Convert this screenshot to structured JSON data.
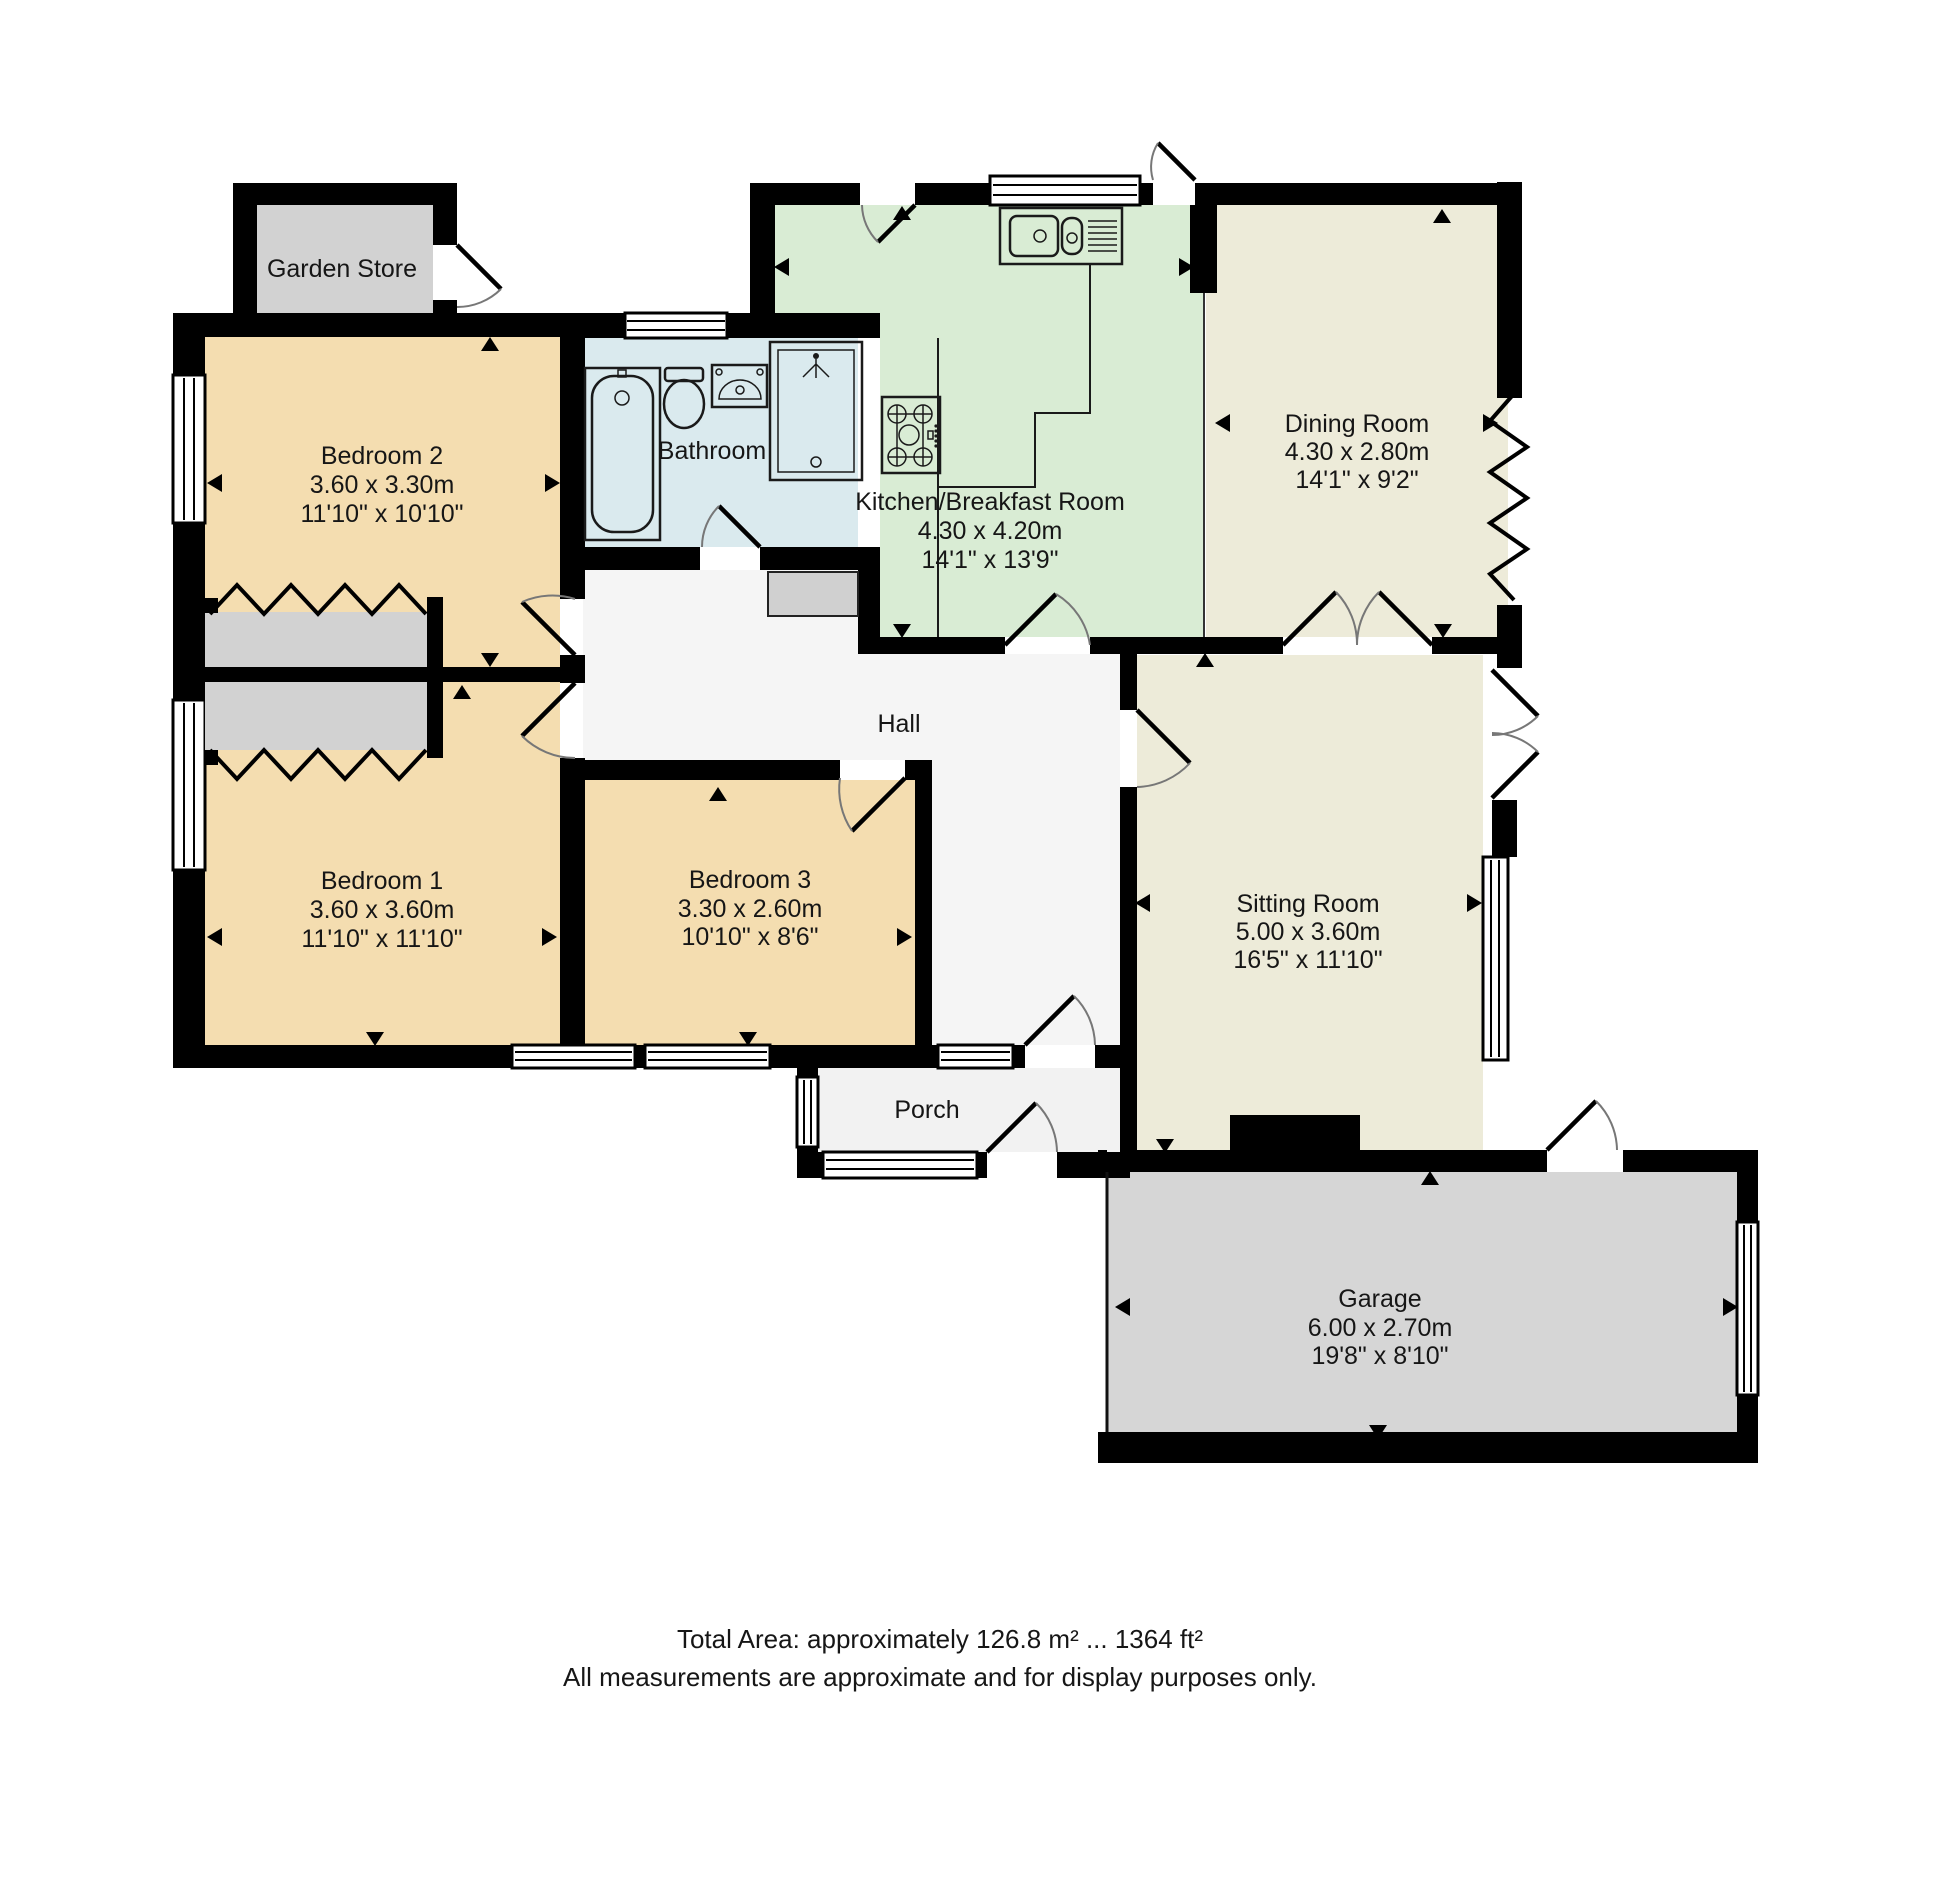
{
  "colors": {
    "bedroom": "#f4ddb0",
    "kitchen": "#d9ecd4",
    "reception": "#edebd9",
    "bathroom": "#daeaee",
    "garage": "#d6d6d6",
    "wardrobe": "#d2d2d2",
    "hall": "#f5f5f5",
    "porch": "#f2f2f2",
    "wall": "#000000"
  },
  "rooms": {
    "garden_store": {
      "name": "Garden Store"
    },
    "bedroom2": {
      "name": "Bedroom 2",
      "dim_m": "3.60 x 3.30m",
      "dim_ft": "11'10\" x 10'10\""
    },
    "bathroom": {
      "name": "Bathroom"
    },
    "kitchen": {
      "name": "Kitchen/Breakfast Room",
      "dim_m": "4.30 x 4.20m",
      "dim_ft": "14'1\" x 13'9\""
    },
    "dining_room": {
      "name": "Dining Room",
      "dim_m": "4.30 x 2.80m",
      "dim_ft": "14'1\" x 9'2\""
    },
    "hall": {
      "name": "Hall"
    },
    "bedroom1": {
      "name": "Bedroom 1",
      "dim_m": "3.60 x 3.60m",
      "dim_ft": "11'10\" x 11'10\""
    },
    "bedroom3": {
      "name": "Bedroom 3",
      "dim_m": "3.30 x 2.60m",
      "dim_ft": "10'10\" x 8'6\""
    },
    "sitting_room": {
      "name": "Sitting Room",
      "dim_m": "5.00 x 3.60m",
      "dim_ft": "16'5\" x 11'10\""
    },
    "porch": {
      "name": "Porch"
    },
    "garage": {
      "name": "Garage",
      "dim_m": "6.00 x 2.70m",
      "dim_ft": "19'8\" x 8'10\""
    }
  },
  "footer": {
    "total_area": "Total Area: approximately 126.8 m² ... 1364 ft²",
    "disclaimer": "All measurements are approximate and for display purposes only."
  }
}
